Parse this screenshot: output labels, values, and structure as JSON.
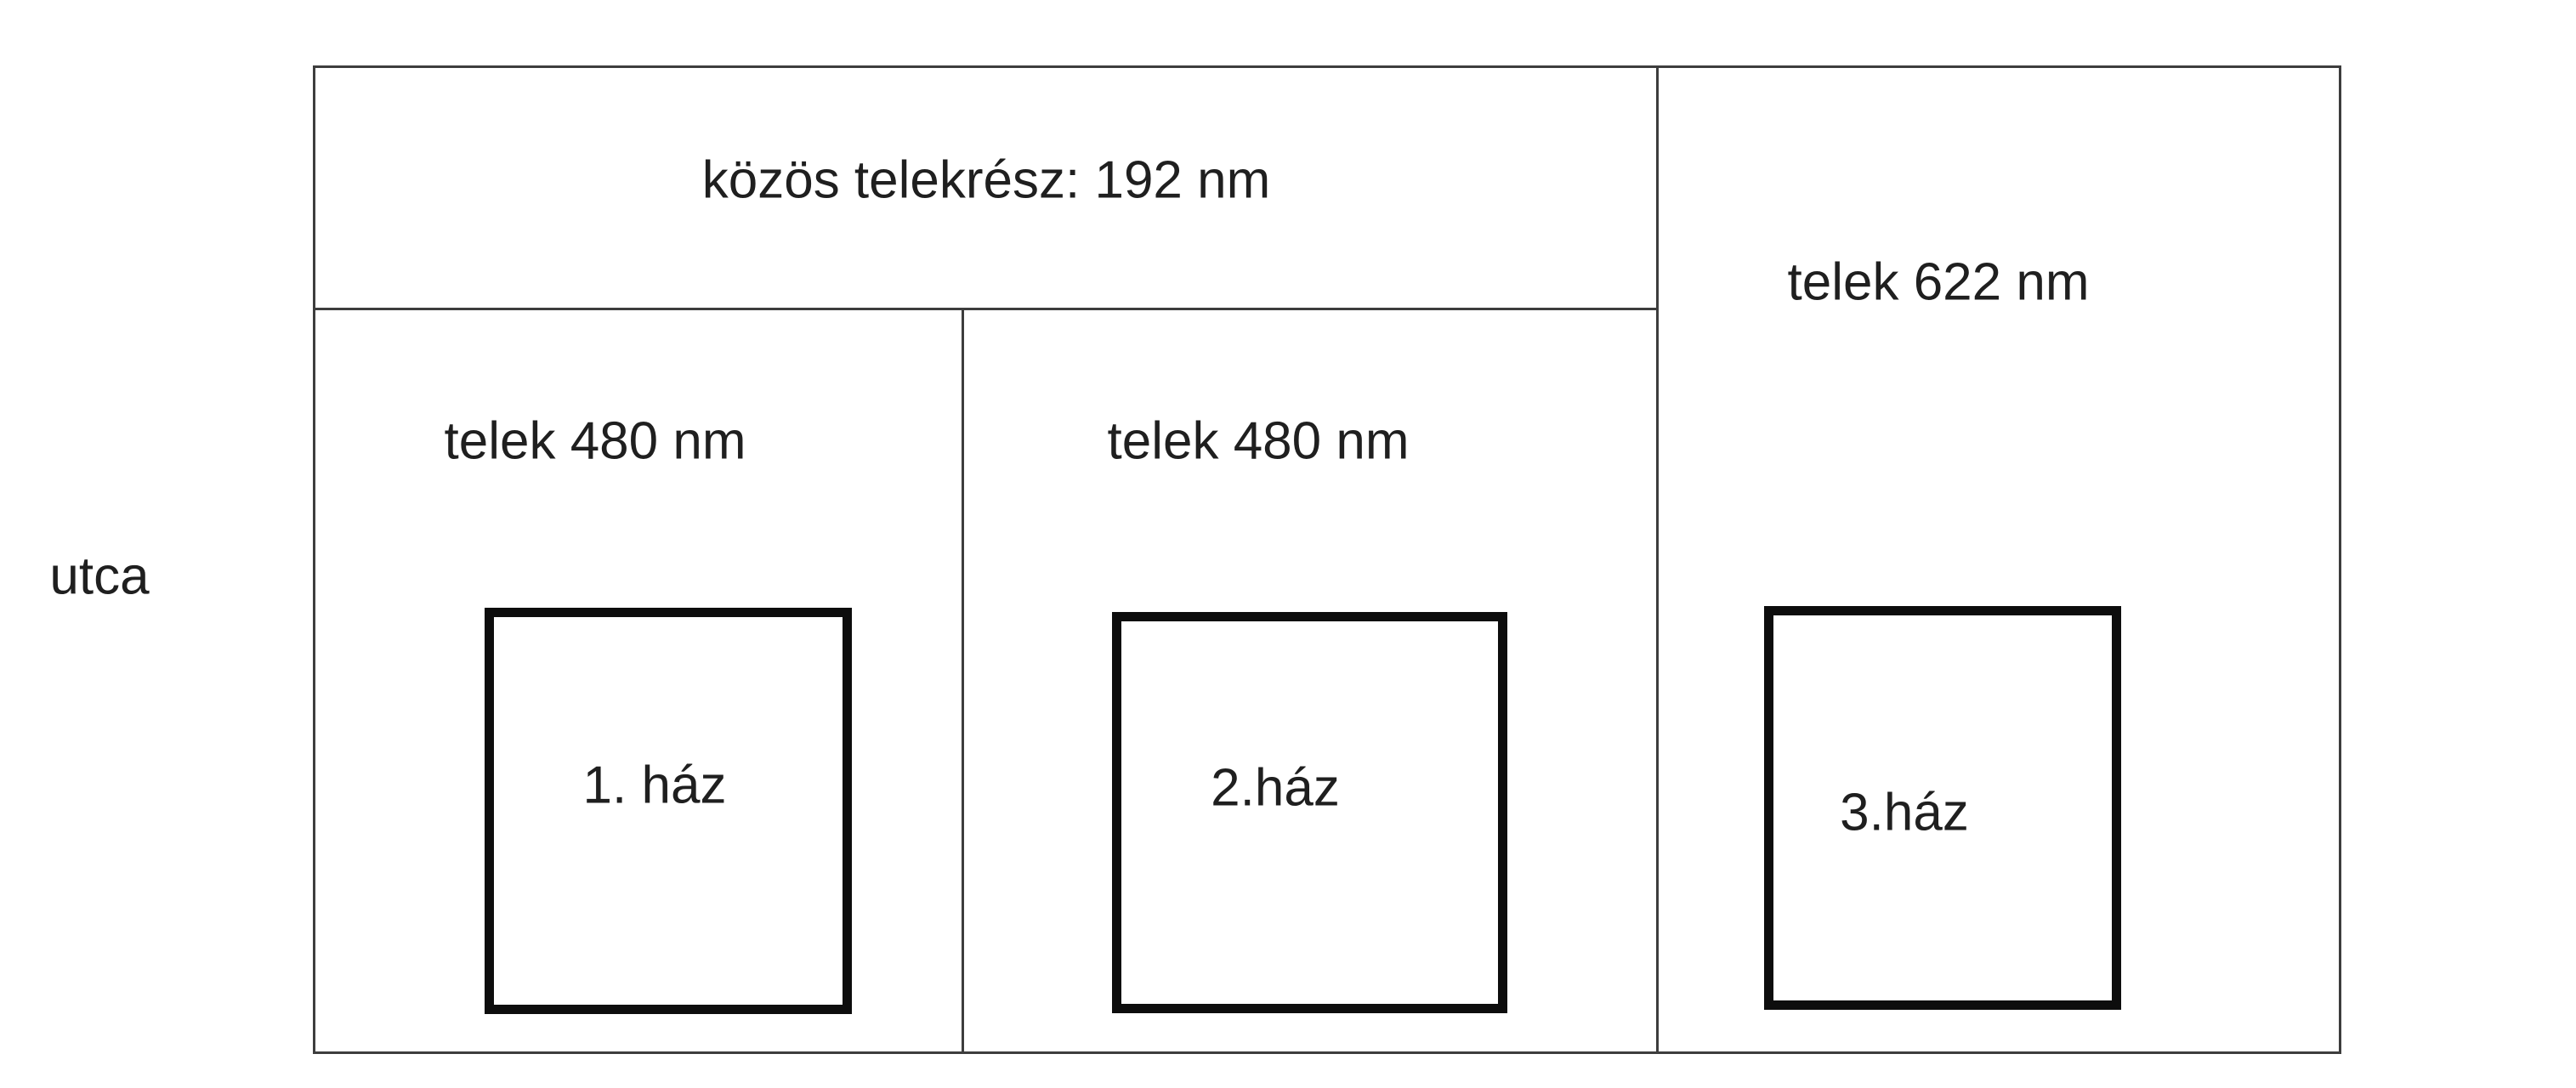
{
  "diagram": {
    "street_label": "utca",
    "common_area_label": "közös telekrész: 192 nm",
    "plots": [
      {
        "area_label": "telek 480 nm",
        "house_label": "1. ház"
      },
      {
        "area_label": "telek 480 nm",
        "house_label": "2.ház"
      },
      {
        "area_label": "telek 622 nm",
        "house_label": "3.ház"
      }
    ]
  },
  "colors": {
    "line": "#3d3d3d",
    "house_border": "#0d0d0d",
    "text": "#1f1f1f",
    "background": "#ffffff"
  }
}
